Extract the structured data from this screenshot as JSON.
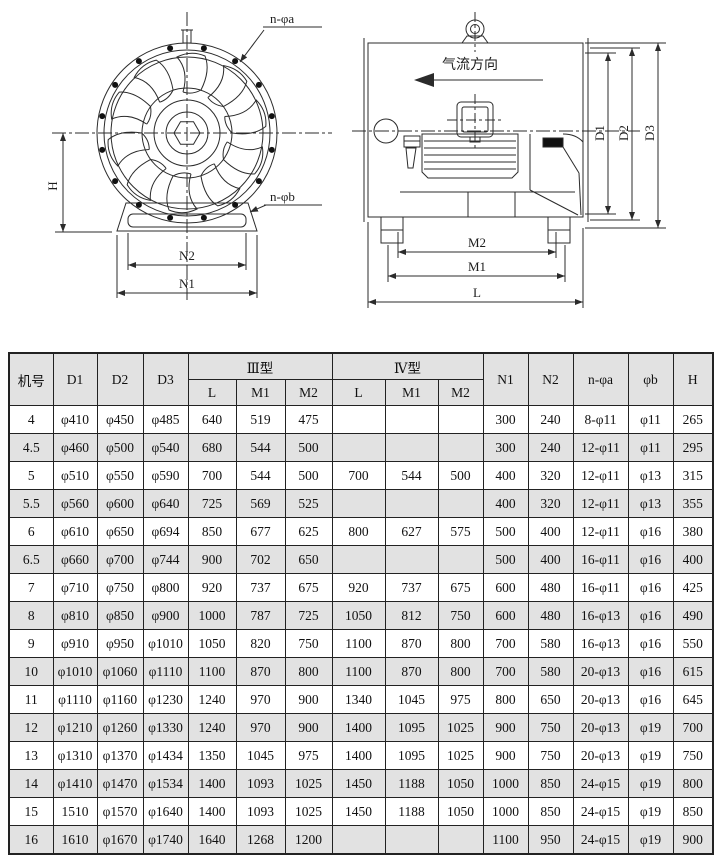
{
  "diagram": {
    "front_view": {
      "label_n_phi_a": "n-φa",
      "label_n_phi_b": "n-φb",
      "label_h": "H",
      "label_n2": "N2",
      "label_n1": "N1"
    },
    "side_view": {
      "airflow_label": "气流方向",
      "label_d1": "D1",
      "label_d2": "D2",
      "label_d3": "D3",
      "label_m2": "M2",
      "label_m1": "M1",
      "label_l": "L"
    }
  },
  "table": {
    "header": {
      "machine_no": "机号",
      "d1": "D1",
      "d2": "D2",
      "d3": "D3",
      "type_iii": "Ⅲ型",
      "type_iv": "Ⅳ型",
      "l": "L",
      "m1": "M1",
      "m2": "M2",
      "n1": "N1",
      "n2": "N2",
      "n_phi_a": "n-φa",
      "phi_b": "φb",
      "h": "H"
    },
    "rows": [
      [
        "4",
        "φ410",
        "φ450",
        "φ485",
        "640",
        "519",
        "475",
        "",
        "",
        "",
        "300",
        "240",
        "8-φ11",
        "φ11",
        "265"
      ],
      [
        "4.5",
        "φ460",
        "φ500",
        "φ540",
        "680",
        "544",
        "500",
        "",
        "",
        "",
        "300",
        "240",
        "12-φ11",
        "φ11",
        "295"
      ],
      [
        "5",
        "φ510",
        "φ550",
        "φ590",
        "700",
        "544",
        "500",
        "700",
        "544",
        "500",
        "400",
        "320",
        "12-φ11",
        "φ13",
        "315"
      ],
      [
        "5.5",
        "φ560",
        "φ600",
        "φ640",
        "725",
        "569",
        "525",
        "",
        "",
        "",
        "400",
        "320",
        "12-φ11",
        "φ13",
        "355"
      ],
      [
        "6",
        "φ610",
        "φ650",
        "φ694",
        "850",
        "677",
        "625",
        "800",
        "627",
        "575",
        "500",
        "400",
        "12-φ11",
        "φ16",
        "380"
      ],
      [
        "6.5",
        "φ660",
        "φ700",
        "φ744",
        "900",
        "702",
        "650",
        "",
        "",
        "",
        "500",
        "400",
        "16-φ11",
        "φ16",
        "400"
      ],
      [
        "7",
        "φ710",
        "φ750",
        "φ800",
        "920",
        "737",
        "675",
        "920",
        "737",
        "675",
        "600",
        "480",
        "16-φ11",
        "φ16",
        "425"
      ],
      [
        "8",
        "φ810",
        "φ850",
        "φ900",
        "1000",
        "787",
        "725",
        "1050",
        "812",
        "750",
        "600",
        "480",
        "16-φ13",
        "φ16",
        "490"
      ],
      [
        "9",
        "φ910",
        "φ950",
        "φ1010",
        "1050",
        "820",
        "750",
        "1100",
        "870",
        "800",
        "700",
        "580",
        "16-φ13",
        "φ16",
        "550"
      ],
      [
        "10",
        "φ1010",
        "φ1060",
        "φ1110",
        "1100",
        "870",
        "800",
        "1100",
        "870",
        "800",
        "700",
        "580",
        "20-φ13",
        "φ16",
        "615"
      ],
      [
        "11",
        "φ1110",
        "φ1160",
        "φ1230",
        "1240",
        "970",
        "900",
        "1340",
        "1045",
        "975",
        "800",
        "650",
        "20-φ13",
        "φ16",
        "645"
      ],
      [
        "12",
        "φ1210",
        "φ1260",
        "φ1330",
        "1240",
        "970",
        "900",
        "1400",
        "1095",
        "1025",
        "900",
        "750",
        "20-φ13",
        "φ19",
        "700"
      ],
      [
        "13",
        "φ1310",
        "φ1370",
        "φ1434",
        "1350",
        "1045",
        "975",
        "1400",
        "1095",
        "1025",
        "900",
        "750",
        "20-φ13",
        "φ19",
        "750"
      ],
      [
        "14",
        "φ1410",
        "φ1470",
        "φ1534",
        "1400",
        "1093",
        "1025",
        "1450",
        "1188",
        "1050",
        "1000",
        "850",
        "24-φ15",
        "φ19",
        "800"
      ],
      [
        "15",
        "1510",
        "φ1570",
        "φ1640",
        "1400",
        "1093",
        "1025",
        "1450",
        "1188",
        "1050",
        "1000",
        "850",
        "24-φ15",
        "φ19",
        "850"
      ],
      [
        "16",
        "1610",
        "φ1670",
        "φ1740",
        "1640",
        "1268",
        "1200",
        "",
        "",
        "",
        "1100",
        "950",
        "24-φ15",
        "φ19",
        "900"
      ]
    ]
  },
  "colors": {
    "row_alt_bg": "#e2e2e2",
    "header_bg": "#e2e2e2",
    "table_border": "#222222",
    "line": "#2b2b2b"
  }
}
